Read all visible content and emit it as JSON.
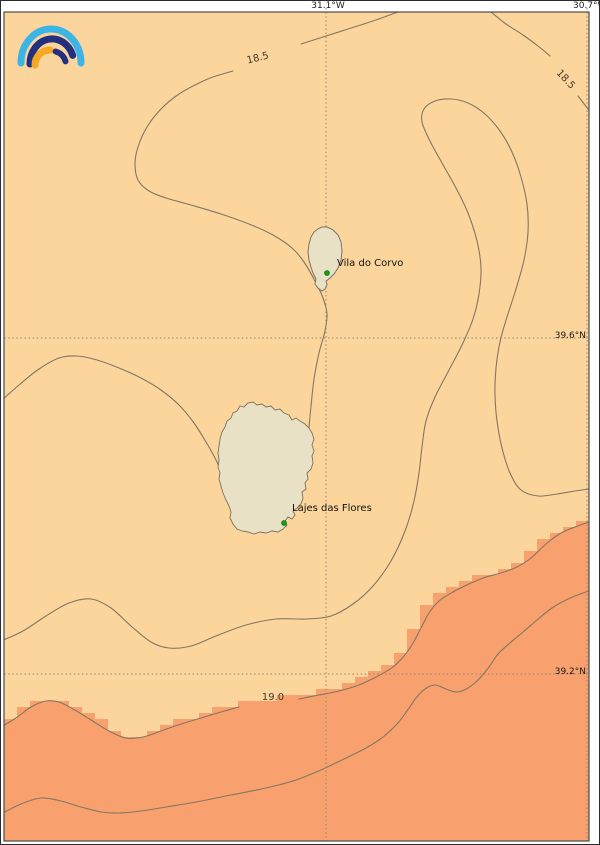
{
  "axis": {
    "lon": [
      {
        "label": "31.1°W"
      },
      {
        "label": "30.7°W"
      }
    ],
    "lat": [
      {
        "label": "39.6°N"
      },
      {
        "label": "39.2°N"
      }
    ]
  },
  "contours": {
    "levels": [
      18.5,
      19.0
    ],
    "label_185_left": "18.5",
    "label_185_right": "18.5",
    "label_190": "19.0"
  },
  "places": {
    "corvo": {
      "name": "Vila do Corvo"
    },
    "flores": {
      "name": "Lajes das Flores"
    }
  },
  "colors": {
    "sea_cool": "#fbd59c",
    "sea_warm": "#f8a16e",
    "land": "#e9e1c5",
    "contour": "#857661",
    "grid": "#8f8574",
    "frame": "#4a4a4a",
    "marker": "#14a012",
    "marker_edge": "#0c6b0c",
    "logo_cyan": "#3cb4e6",
    "logo_navy": "#23307d",
    "logo_orange": "#f7a823"
  }
}
